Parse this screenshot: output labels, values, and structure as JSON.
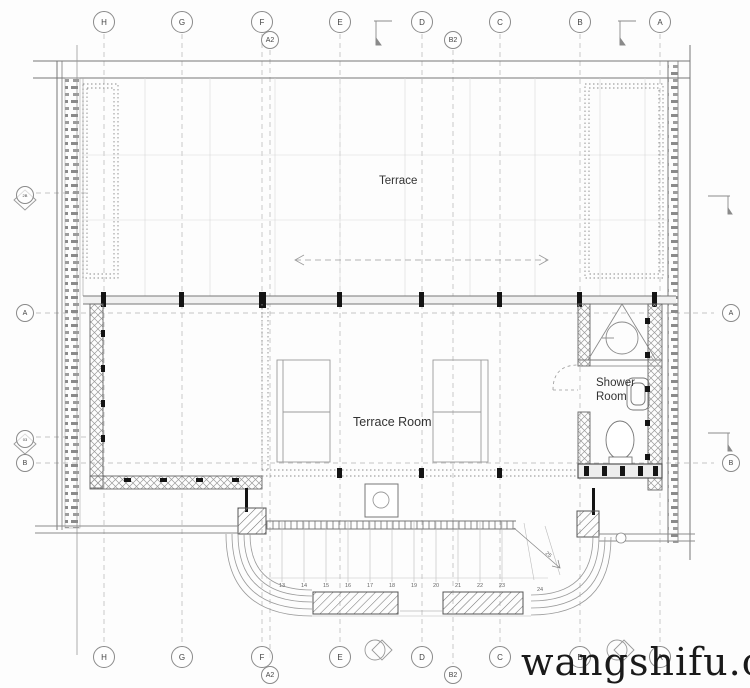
{
  "title": "terrace-floor-plan",
  "labels": {
    "terrace": "Terrace",
    "terrace_room": "Terrace Room",
    "shower_line1": "Shower",
    "shower_line2": "Room",
    "stair_note": "25"
  },
  "grid_top": [
    {
      "label": "H"
    },
    {
      "label": "G"
    },
    {
      "label": "F"
    },
    {
      "label": "E"
    },
    {
      "label": "D"
    },
    {
      "label": "C"
    },
    {
      "label": "B"
    },
    {
      "label": "A"
    }
  ],
  "grid_top_sub": [
    {
      "label": "A2"
    },
    {
      "label": "B2"
    }
  ],
  "grid_bottom": [
    {
      "label": "H"
    },
    {
      "label": "G"
    },
    {
      "label": "F"
    },
    {
      "label": "E"
    },
    {
      "label": "D"
    },
    {
      "label": "C"
    },
    {
      "label": "B"
    },
    {
      "label": "A"
    }
  ],
  "grid_bottom_sub": [
    {
      "label": "A2"
    },
    {
      "label": "B2"
    }
  ],
  "grid_left": [
    {
      "label": "2B"
    },
    {
      "label": "A"
    },
    {
      "label": "03"
    },
    {
      "label": "B"
    }
  ],
  "grid_right": [
    {
      "label": "A"
    },
    {
      "label": "B"
    }
  ],
  "stair_numbers": [
    "13",
    "14",
    "15",
    "16",
    "17",
    "18",
    "19",
    "20",
    "21",
    "22",
    "23",
    "24"
  ],
  "watermark": "wangshifu.cn",
  "colors": {
    "line_light": "#c9c9c9",
    "line_grid": "#b3b3b3",
    "line_mid": "#8c8c8c",
    "wall_dark": "#555555",
    "post_black": "#141414",
    "watermark": "#1a1a1a",
    "background": "#fdfdfd"
  }
}
